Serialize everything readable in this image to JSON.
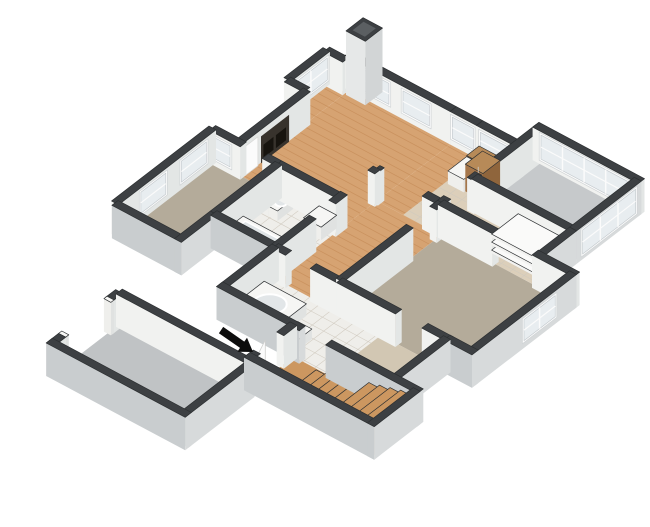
{
  "image": {
    "type": "3d-floor-plan-render",
    "background": "#ffffff"
  },
  "palette": {
    "outline": "#2c2f31",
    "wall_cap": "#3d4043",
    "wall_int_face": "#f1f2f0",
    "wall_int_side": "#e3e6e5",
    "wall_ext_face": "#c9cdcf",
    "wall_ext_side": "#d7dadb",
    "wood": "#d6a372",
    "wood_line": "#c08550",
    "wood_stair": "#cc9760",
    "carpet": "#b4ab9a",
    "carpet_beige": "#d2c7b3",
    "tile_white": "#efeeea",
    "tile_beige": "#dccfba",
    "tile_line": "#d0cabf",
    "concrete": "#c6c9cb",
    "concrete_garage": "#c0c3c5",
    "cabinet_top": "#b78a58",
    "cabinet_front": "#8f653c",
    "cabinet_side": "#a5764a",
    "fixture": "#f6f6f4",
    "glass": "#e8edf0",
    "frame": "#fbfbfb",
    "fireplace": "#38332d",
    "fireplace_inner": "#17140f",
    "arrow": "#0d0d0d"
  },
  "rooms": [
    {
      "id": "bay-window-alcove",
      "floor": "wood"
    },
    {
      "id": "living-room",
      "floor": "wood"
    },
    {
      "id": "dining-area",
      "floor": "wood"
    },
    {
      "id": "kitchen",
      "floor": "tile_beige"
    },
    {
      "id": "pantry-nook",
      "floor": "tile_beige"
    },
    {
      "id": "balcony",
      "floor": "concrete"
    },
    {
      "id": "hallway",
      "floor": "wood"
    },
    {
      "id": "master-bedroom",
      "floor": "carpet"
    },
    {
      "id": "bedroom-2",
      "floor": "carpet"
    },
    {
      "id": "bathroom-2",
      "floor": "tile_white"
    },
    {
      "id": "master-bathroom",
      "floor": "tile_white"
    },
    {
      "id": "walk-in-closet",
      "floor": "carpet_beige"
    },
    {
      "id": "entry-stair-hall",
      "floor": "wood_stair"
    },
    {
      "id": "garage",
      "floor": "concrete_garage"
    }
  ],
  "icons": [
    {
      "name": "entry-arrow-icon",
      "meaning": "unit entry direction",
      "color": "#0d0d0d"
    }
  ]
}
